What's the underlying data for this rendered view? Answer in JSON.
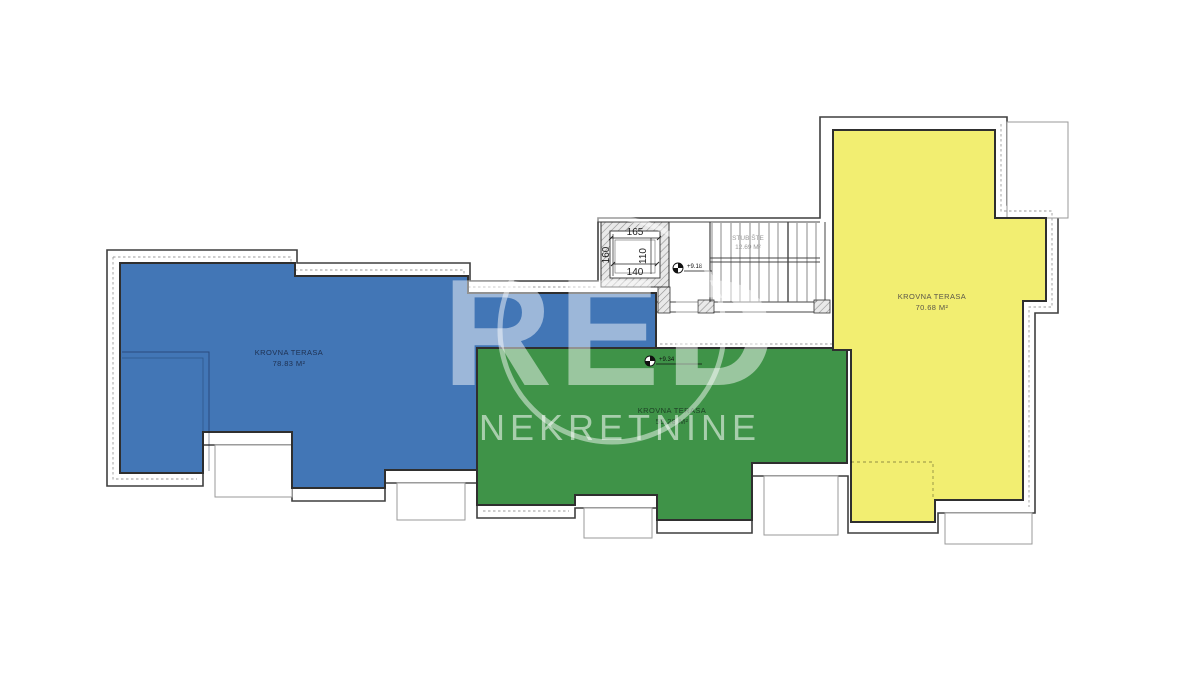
{
  "plan": {
    "watermark": {
      "logo_text": "RED",
      "brand_text": "NEKRETNINE"
    },
    "terraces": [
      {
        "id": "blue-terrace",
        "label": "KROVNA TERASA",
        "area": "78.83 M²",
        "color": "#4276b6",
        "label_color": "#1e3050"
      },
      {
        "id": "green-terrace",
        "label": "KROVNA TERASA",
        "area": "55.28 M²",
        "color": "#3f9348",
        "label_color": "#1c3f24"
      },
      {
        "id": "yellow-terrace",
        "label": "KROVNA TERASA",
        "area": "70.68 M²",
        "color": "#f2ee71",
        "label_color": "#5a564a"
      }
    ],
    "staircase": {
      "label": "STUBIŠTE",
      "area": "12.69 M²"
    },
    "elevator_dims": {
      "top": "165",
      "left": "160",
      "inner_right": "110",
      "inner_bottom": "140"
    },
    "level_markers": [
      {
        "value": "+9.18"
      },
      {
        "value": "+9.34"
      }
    ],
    "colors": {
      "outline": "#3f3f3f",
      "secondary_line": "#969696",
      "watermark_white": "rgba(255,255,255,0.48)"
    }
  }
}
